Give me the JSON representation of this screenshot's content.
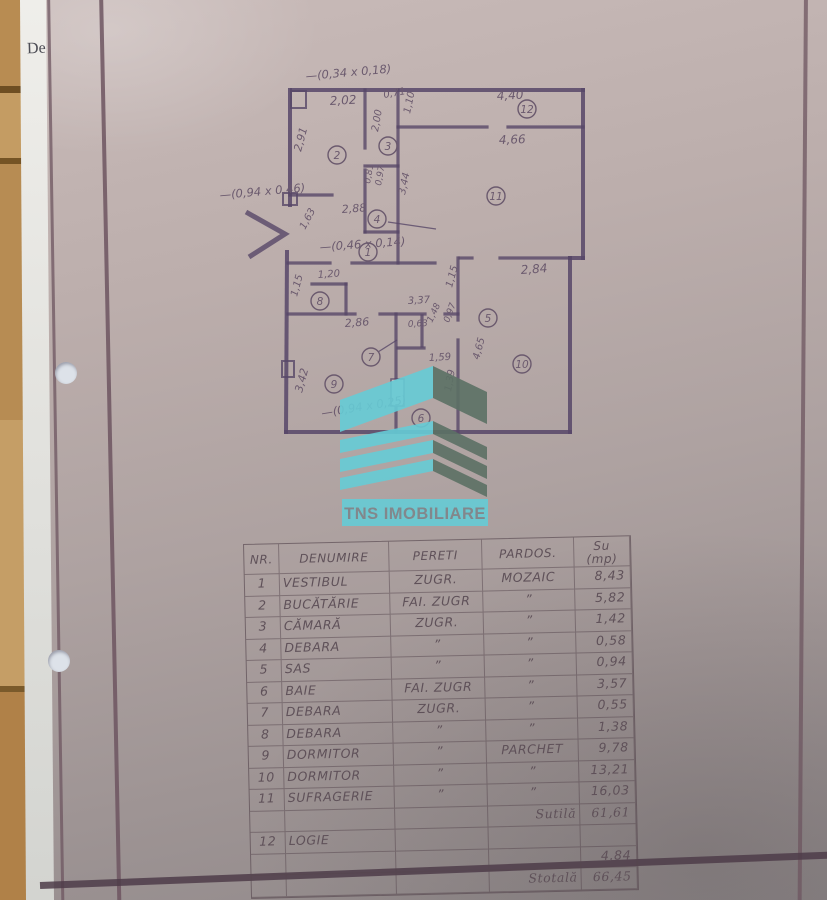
{
  "scan": {
    "peek_text": "De",
    "logo": {
      "text": "TNS IMOBILIARE",
      "cyan": "#66ccd6",
      "dark_side": "#5c7165",
      "text_color": "#7e858a"
    },
    "plan": {
      "room_numbers": [
        {
          "n": "1",
          "x": 368,
          "y": 252
        },
        {
          "n": "2",
          "x": 337,
          "y": 155
        },
        {
          "n": "3",
          "x": 388,
          "y": 146
        },
        {
          "n": "4",
          "x": 377,
          "y": 219
        },
        {
          "n": "5",
          "x": 488,
          "y": 318
        },
        {
          "n": "6",
          "x": 421,
          "y": 418
        },
        {
          "n": "7",
          "x": 371,
          "y": 357
        },
        {
          "n": "8",
          "x": 320,
          "y": 301
        },
        {
          "n": "9",
          "x": 334,
          "y": 384
        },
        {
          "n": "10",
          "x": 522,
          "y": 364
        },
        {
          "n": "11",
          "x": 496,
          "y": 196
        },
        {
          "n": "12",
          "x": 527,
          "y": 109
        }
      ],
      "dimensions": [
        {
          "t": "2,02",
          "x": 330,
          "y": 105,
          "r": -3,
          "s": 12
        },
        {
          "t": "0,71",
          "x": 384,
          "y": 98,
          "r": -10,
          "s": 10
        },
        {
          "t": "4,40",
          "x": 497,
          "y": 100,
          "r": -3,
          "s": 12
        },
        {
          "t": "1,10",
          "x": 410,
          "y": 114,
          "r": -78,
          "s": 10
        },
        {
          "t": "4,66",
          "x": 499,
          "y": 144,
          "r": -2,
          "s": 12
        },
        {
          "t": "2,91",
          "x": 301,
          "y": 152,
          "r": -75,
          "s": 11
        },
        {
          "t": "2,00",
          "x": 378,
          "y": 132,
          "r": -80,
          "s": 10
        },
        {
          "t": "0,81",
          "x": 370,
          "y": 184,
          "r": -80,
          "s": 9
        },
        {
          "t": "0,97",
          "x": 381,
          "y": 186,
          "r": -80,
          "s": 9
        },
        {
          "t": "3,44",
          "x": 405,
          "y": 195,
          "r": -78,
          "s": 10
        },
        {
          "t": "2,88",
          "x": 342,
          "y": 213,
          "r": -4,
          "s": 11
        },
        {
          "t": "1,63",
          "x": 305,
          "y": 230,
          "r": -62,
          "s": 10
        },
        {
          "t": "1,20",
          "x": 318,
          "y": 278,
          "r": -4,
          "s": 10
        },
        {
          "t": "1,15",
          "x": 297,
          "y": 297,
          "r": -75,
          "s": 10
        },
        {
          "t": "2,86",
          "x": 345,
          "y": 327,
          "r": -4,
          "s": 11
        },
        {
          "t": "3,37",
          "x": 408,
          "y": 304,
          "r": -3,
          "s": 10
        },
        {
          "t": "2,84",
          "x": 521,
          "y": 274,
          "r": -4,
          "s": 12
        },
        {
          "t": "1,15",
          "x": 452,
          "y": 288,
          "r": -75,
          "s": 10
        },
        {
          "t": "0,63",
          "x": 408,
          "y": 327,
          "r": -3,
          "s": 9
        },
        {
          "t": "1,48",
          "x": 432,
          "y": 323,
          "r": -65,
          "s": 9
        },
        {
          "t": "0,97",
          "x": 449,
          "y": 323,
          "r": -70,
          "s": 9
        },
        {
          "t": "1,59",
          "x": 429,
          "y": 361,
          "r": -3,
          "s": 10
        },
        {
          "t": "4,65",
          "x": 479,
          "y": 360,
          "r": -75,
          "s": 10
        },
        {
          "t": "1,39",
          "x": 451,
          "y": 392,
          "r": -80,
          "s": 10
        },
        {
          "t": "3,42",
          "x": 302,
          "y": 393,
          "r": -75,
          "s": 11
        }
      ],
      "annotations": [
        {
          "t": "—(0,34 x 0,18)",
          "x": 306,
          "y": 80,
          "r": -5
        },
        {
          "t": "—(0,94 x 0,46)",
          "x": 220,
          "y": 199,
          "r": -5
        },
        {
          "t": "—(0,46 x 0,14)",
          "x": 320,
          "y": 251,
          "r": -4
        },
        {
          "t": "—(0,94 x 0,25)",
          "x": 322,
          "y": 417,
          "r": -9
        }
      ]
    },
    "table": {
      "headers": [
        "NR.",
        "DENUMIRE",
        "PERETI",
        "PARDOS.",
        "Su\n(mp)"
      ],
      "rows": [
        {
          "nr": "1",
          "den": "VESTIBUL",
          "per": "ZUGR.",
          "par": "MOZAIC",
          "su": "8,43"
        },
        {
          "nr": "2",
          "den": "BUCĂTĂRIE",
          "per": "FAI. ZUGR",
          "par": "”",
          "su": "5,82"
        },
        {
          "nr": "3",
          "den": "CĂMARĂ",
          "per": "ZUGR.",
          "par": "”",
          "su": "1,42"
        },
        {
          "nr": "4",
          "den": "DEBARA",
          "per": "”",
          "par": "”",
          "su": "0,58"
        },
        {
          "nr": "5",
          "den": "SAS",
          "per": "”",
          "par": "”",
          "su": "0,94"
        },
        {
          "nr": "6",
          "den": "BAIE",
          "per": "FAI. ZUGR",
          "par": "”",
          "su": "3,57"
        },
        {
          "nr": "7",
          "den": "DEBARA",
          "per": "ZUGR.",
          "par": "”",
          "su": "0,55"
        },
        {
          "nr": "8",
          "den": "DEBARA",
          "per": "”",
          "par": "”",
          "su": "1,38"
        },
        {
          "nr": "9",
          "den": "DORMITOR",
          "per": "”",
          "par": "PARCHET",
          "su": "9,78"
        },
        {
          "nr": "10",
          "den": "DORMITOR",
          "per": "”",
          "par": "”",
          "su": "13,21"
        },
        {
          "nr": "11",
          "den": "SUFRAGERIE",
          "per": "”",
          "par": "”",
          "su": "16,03"
        },
        {
          "nr": "",
          "den": "",
          "per": "",
          "par": "Sutilă",
          "su": "61,61",
          "script": true
        },
        {
          "nr": "12",
          "den": "LOGIE",
          "per": "",
          "par": "",
          "su": ""
        },
        {
          "nr": "",
          "den": "",
          "per": "",
          "par": "",
          "su": "4,84"
        },
        {
          "nr": "",
          "den": "",
          "per": "",
          "par": "Stotală",
          "su": "66,45",
          "script": true
        }
      ]
    }
  }
}
